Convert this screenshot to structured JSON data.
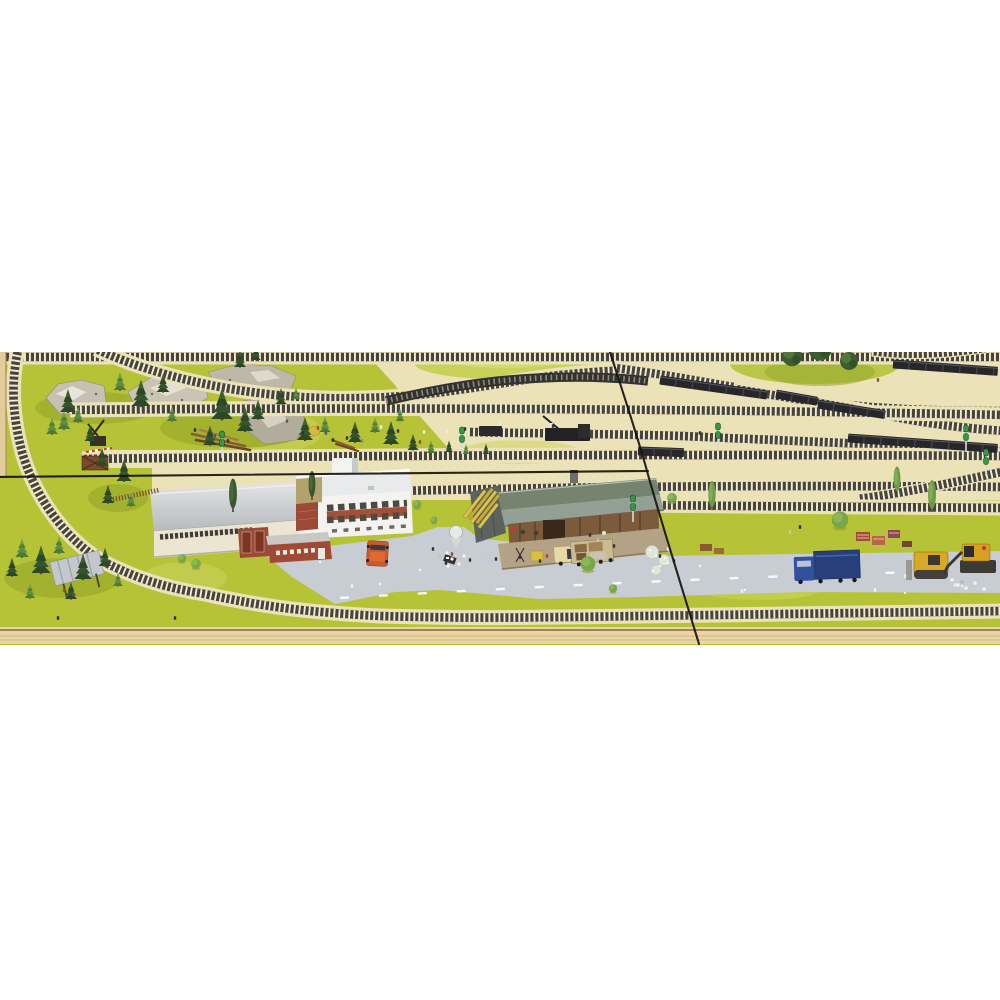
{
  "meta": {
    "description": "Photograph of a model railway layout viewed from above: a station area with goods shed, marshalling yard tracks with parked freight wagon rakes, pine forest scenery on grass mat, road with trucks and construction machines, baseboard wood edge at bottom, and two crack seams across the photo. White background above and below the photo.",
    "image_type": "photograph",
    "photo_area": {
      "x": 0,
      "y": 352,
      "width": 1000,
      "height": 293
    }
  },
  "palette": {
    "white": "#ffffff",
    "grass": "#b6c336",
    "grass-light": "#cdd55e",
    "grass-dark": "#93a52b",
    "ballast": "#ece2b8",
    "ballast-light": "#f4edd3",
    "tie": "#47443c",
    "road": "#c8cdd3",
    "wood": "#e9d6a4",
    "wood-dark": "#c9a368",
    "crack": "#16130e",
    "bldg-white": "#f4f3ef",
    "roof-gray": "#cfd3d5",
    "brick-red": "#9c4936",
    "door-red": "#7c3522",
    "shed-brown": "#7c5a3c",
    "shed-roof": "#93a095",
    "shed-roof-dark": "#75836f",
    "lumber-yellow": "#d9c452",
    "van-orange": "#cc5a28",
    "truck-yellow": "#e7d9a2",
    "truck-blue": "#33509c",
    "tarp-blue": "#27407c",
    "dozer-yellow": "#d8a826",
    "wagon-black": "#26262b",
    "signal-green": "#2f9a48",
    "pine-dark": "#2c4826",
    "pine-light": "#54803c"
  },
  "scene": {
    "legend": {
      "trees": "[type, x, y, scale] — types: pine, lpine, decid, ddecid, poplar, lpoplar",
      "figures": "[x, y, color] tiny model people and animals",
      "wagon_rakes": "[x, y, length, angle_deg] parked black freight wagon strings",
      "signals": "[x, y] green twin-head dwarf signals on poles"
    },
    "trees": [
      [
        "pine",
        68,
        412,
        1.0
      ],
      [
        "lpine",
        52,
        434,
        0.8
      ],
      [
        "lpine",
        64,
        429,
        0.85
      ],
      [
        "lpine",
        78,
        422,
        0.75
      ],
      [
        "pine",
        90,
        441,
        0.7
      ],
      [
        "pine",
        141,
        406,
        1.15
      ],
      [
        "lpine",
        120,
        390,
        0.85
      ],
      [
        "pine",
        163,
        392,
        0.8
      ],
      [
        "lpine",
        172,
        421,
        0.7
      ],
      [
        "pine",
        222,
        419,
        1.35
      ],
      [
        "pine",
        245,
        431,
        1.05
      ],
      [
        "pine",
        210,
        445,
        0.85
      ],
      [
        "pine",
        258,
        419,
        0.85
      ],
      [
        "pine",
        281,
        404,
        0.7
      ],
      [
        "lpine",
        296,
        399,
        0.55
      ],
      [
        "pine",
        240,
        367,
        0.75
      ],
      [
        "pine",
        256,
        360,
        0.6
      ],
      [
        "pine",
        305,
        440,
        1.0
      ],
      [
        "lpine",
        325,
        432,
        0.75
      ],
      [
        "pine",
        355,
        442,
        0.9
      ],
      [
        "lpine",
        375,
        432,
        0.7
      ],
      [
        "pine",
        391,
        444,
        1.0
      ],
      [
        "lpine",
        400,
        421,
        0.6
      ],
      [
        "pine",
        413,
        450,
        0.7
      ],
      [
        "lpine",
        431,
        453,
        0.6
      ],
      [
        "pine",
        449,
        452,
        0.5
      ],
      [
        "lpine",
        466,
        454,
        0.48
      ],
      [
        "pine",
        486,
        454,
        0.45
      ],
      [
        "pine",
        102,
        466,
        0.8
      ],
      [
        "pine",
        124,
        481,
        0.95
      ],
      [
        "pine",
        108,
        503,
        0.8
      ],
      [
        "lpine",
        131,
        506,
        0.65
      ],
      [
        "lpine",
        22,
        557,
        0.9
      ],
      [
        "pine",
        41,
        573,
        1.2
      ],
      [
        "lpine",
        59,
        553,
        0.8
      ],
      [
        "pine",
        83,
        579,
        1.1
      ],
      [
        "pine",
        105,
        566,
        0.8
      ],
      [
        "lpine",
        30,
        598,
        0.7
      ],
      [
        "pine",
        71,
        599,
        0.75
      ],
      [
        "lpine",
        118,
        586,
        0.65
      ],
      [
        "pine",
        12,
        576,
        0.8
      ],
      [
        "poplar",
        233,
        512,
        1.15
      ],
      [
        "poplar",
        312,
        500,
        1.0
      ],
      [
        "lpoplar",
        712,
        510,
        1.0
      ],
      [
        "lpoplar",
        897,
        494,
        0.95
      ],
      [
        "lpoplar",
        932,
        512,
        1.1
      ],
      [
        "ddecid",
        792,
        364,
        1.1
      ],
      [
        "ddecid",
        820,
        358,
        1.3
      ],
      [
        "ddecid",
        849,
        368,
        1.0
      ],
      [
        "decid",
        840,
        527,
        1.2
      ],
      [
        "decid",
        588,
        570,
        1.05
      ],
      [
        "decid",
        613,
        592,
        0.6
      ],
      [
        "decid",
        417,
        508,
        0.62
      ],
      [
        "decid",
        434,
        523,
        0.5
      ],
      [
        "decid",
        672,
        502,
        0.7
      ],
      [
        "decid",
        196,
        568,
        0.7
      ],
      [
        "decid",
        182,
        562,
        0.6
      ]
    ],
    "figures": [
      [
        287,
        421,
        "#6a5a42"
      ],
      [
        303,
        433,
        "#32322e"
      ],
      [
        318,
        428,
        "#a8472e"
      ],
      [
        347,
        438,
        "#32322e"
      ],
      [
        362,
        441,
        "#8a8a8a"
      ],
      [
        398,
        431,
        "#32322e"
      ],
      [
        420,
        442,
        "#a8472e"
      ],
      [
        447,
        431,
        "#ececec"
      ],
      [
        424,
        432,
        "#f0f0ec"
      ],
      [
        381,
        427,
        "#f0f0ec"
      ],
      [
        465,
        429,
        "#32322e"
      ],
      [
        500,
        424,
        "#e8e8e6"
      ],
      [
        553,
        426,
        "#32322e"
      ],
      [
        700,
        433,
        "#32322e"
      ],
      [
        878,
        380,
        "#7a5a3a"
      ],
      [
        195,
        430,
        "#32322e"
      ],
      [
        215,
        436,
        "#3e5a8a"
      ],
      [
        228,
        441,
        "#32322e"
      ],
      [
        326,
        433,
        "#3e5a8a"
      ],
      [
        333,
        440,
        "#32322e"
      ],
      [
        433,
        549,
        "#32322e"
      ],
      [
        440,
        557,
        "#c0c0bc"
      ],
      [
        446,
        563,
        "#32322e"
      ],
      [
        452,
        554,
        "#a8472e"
      ],
      [
        470,
        560,
        "#32322e"
      ],
      [
        482,
        556,
        "#c8c8c4"
      ],
      [
        496,
        559,
        "#32322e"
      ],
      [
        520,
        557,
        "#32322e"
      ],
      [
        547,
        556,
        "#c23a28"
      ],
      [
        540,
        561,
        "#32322e"
      ],
      [
        590,
        535,
        "#32322e"
      ],
      [
        598,
        540,
        "#c0c0bc"
      ],
      [
        614,
        546,
        "#32322e"
      ],
      [
        660,
        556,
        "#32322e"
      ],
      [
        668,
        549,
        "#ececec"
      ],
      [
        674,
        561,
        "#32322e"
      ],
      [
        790,
        532,
        "#c8c8c4"
      ],
      [
        800,
        527,
        "#32322e"
      ],
      [
        905,
        576,
        "#ececec"
      ],
      [
        955,
        585,
        "#ececec"
      ],
      [
        742,
        591,
        "#f0f0ec"
      ],
      [
        875,
        590,
        "#f0f0ec"
      ],
      [
        352,
        586,
        "#f0f0ec"
      ],
      [
        64,
        590,
        "#8a5a32"
      ],
      [
        74,
        595,
        "#7a4a28"
      ],
      [
        58,
        618,
        "#2a2a2a"
      ],
      [
        175,
        618,
        "#2a2a2a"
      ]
    ],
    "wagon_rakes": [
      [
        893,
        364,
        105,
        4
      ],
      [
        660,
        380,
        108,
        8
      ],
      [
        776,
        394,
        42,
        10
      ],
      [
        818,
        404,
        68,
        9
      ],
      [
        848,
        438,
        150,
        4
      ],
      [
        638,
        451,
        46,
        2
      ]
    ],
    "signals": [
      [
        462,
        428
      ],
      [
        633,
        496
      ],
      [
        718,
        424
      ],
      [
        966,
        426
      ],
      [
        986,
        450
      ],
      [
        222,
        432
      ]
    ]
  }
}
